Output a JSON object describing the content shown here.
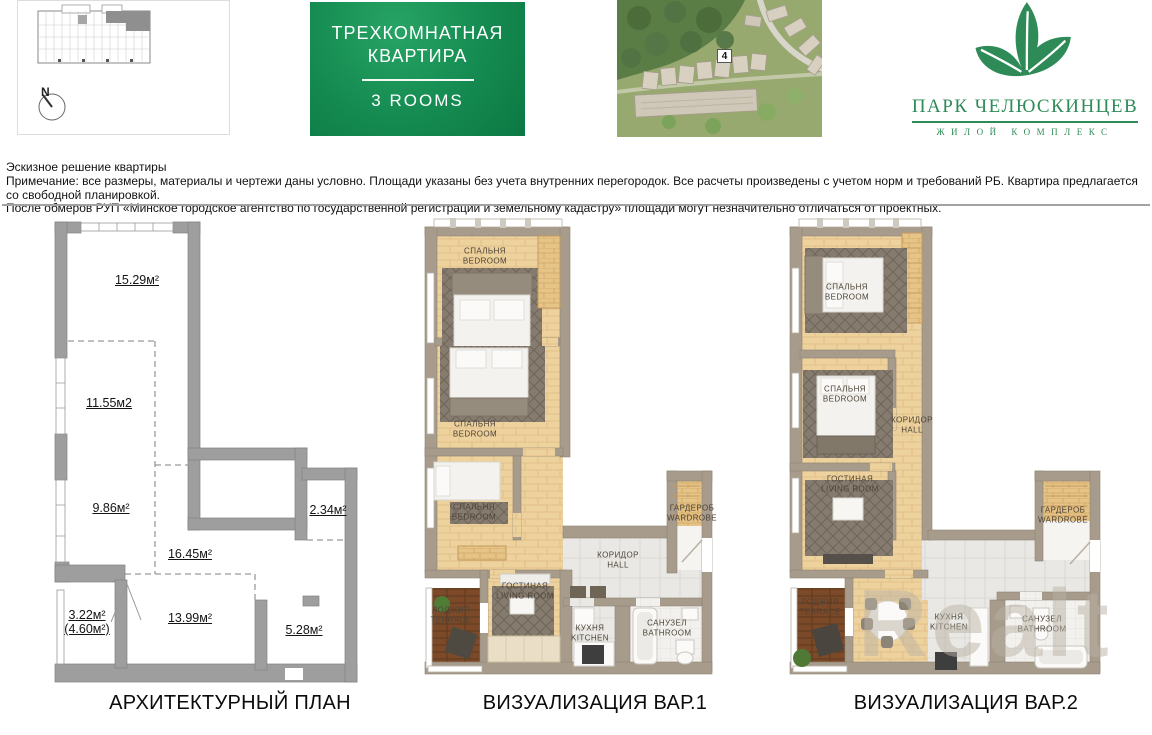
{
  "header": {
    "key_plan": {
      "compass": "N"
    },
    "banner": {
      "line1": "ТРЕХКОМНАТНАЯ",
      "line2": "КВАРТИРА",
      "subtitle": "3 ROOMS"
    },
    "map": {
      "marker": "4"
    },
    "logo": {
      "title": "ПАРК ЧЕЛЮСКИНЦЕВ",
      "subtitle": "ЖИЛОЙ КОМПЛЕКС",
      "brand_green": "#2e8b57"
    }
  },
  "notes": {
    "line1": "Эскизное решение квартиры",
    "line2": "Примечание: все размеры, материалы и чертежи даны условно. Площади указаны без учета внутренних перегородок. Все расчеты произведены с учетом норм и требований РБ. Квартира предлагается со свободной планировкой.",
    "line3": "После обмеров РУП «Минское городское агентство по государственной регистрации и земельному кадастру» площади могут незначительно отличаться от проектных."
  },
  "architectural": {
    "caption": "АРХИТЕКТУРНЫЙ ПЛАН",
    "areas": {
      "a1": "15.29м²",
      "a2": "11.55м2",
      "a3": "9.86м²",
      "a4": "2.34м²",
      "a5": "16.45м²",
      "a6": "3.22м²",
      "a6b": "(4.60м²)",
      "a7": "13.99м²",
      "a8": "5.28м²"
    }
  },
  "viz1": {
    "caption": "ВИЗУАЛИЗАЦИЯ ВАР.1",
    "rooms": {
      "bedroom1": {
        "ru": "СПАЛЬНЯ",
        "en": "BEDROOM"
      },
      "bedroom2": {
        "ru": "СПАЛЬНЯ",
        "en": "BEDROOM"
      },
      "bedroom3": {
        "ru": "СПАЛЬНЯ",
        "en": "BEDROOM"
      },
      "living": {
        "ru": "ГОСТИНАЯ",
        "en": "LIVING ROOM"
      },
      "hall": {
        "ru": "КОРИДОР",
        "en": "HALL"
      },
      "wardrobe": {
        "ru": "ГАРДЕРОБ",
        "en": "WARDROBE"
      },
      "loggia": {
        "ru": "ЛОДЖИЯ",
        "en": "TERRACE"
      },
      "kitchen": {
        "ru": "КУХНЯ",
        "en": "KITCHEN"
      },
      "bathroom": {
        "ru": "САНУЗЕЛ",
        "en": "BATHROOM"
      }
    }
  },
  "viz2": {
    "caption": "ВИЗУАЛИЗАЦИЯ ВАР.2",
    "rooms": {
      "bedroom1": {
        "ru": "СПАЛЬНЯ",
        "en": "BEDROOM"
      },
      "bedroom2": {
        "ru": "СПАЛЬНЯ",
        "en": "BEDROOM"
      },
      "hall": {
        "ru": "КОРИДОР",
        "en": "HALL"
      },
      "living": {
        "ru": "ГОСТИНАЯ",
        "en": "LIVING ROOM"
      },
      "wardrobe": {
        "ru": "ГАРДЕРОБ",
        "en": "WARDROBE"
      },
      "loggia": {
        "ru": "ЛОДЖИЯ",
        "en": "TERRACE"
      },
      "kitchen": {
        "ru": "КУХНЯ",
        "en": "KITCHEN"
      },
      "bathroom": {
        "ru": "САНУЗЕЛ",
        "en": "BATHROOM"
      }
    }
  },
  "watermark": "Realt"
}
